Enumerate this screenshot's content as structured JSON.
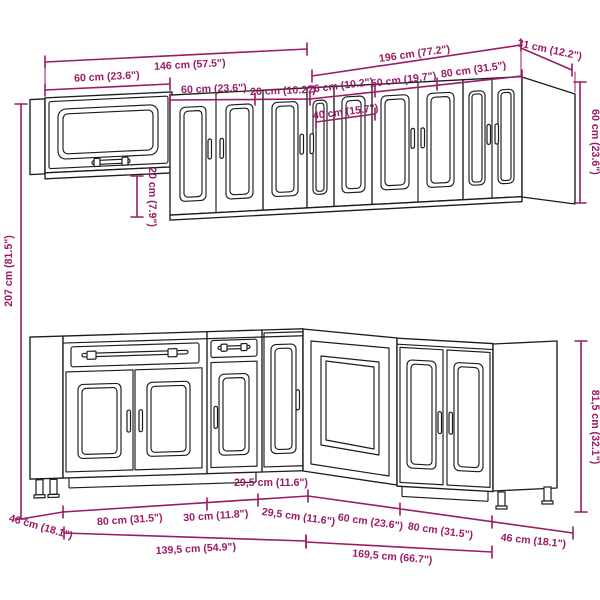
{
  "diagram": {
    "type": "kitchen-cabinet-set-dimension-diagram",
    "colors": {
      "dimension": "#9b1b66",
      "line": "#1c1c1c",
      "background": "#ffffff"
    },
    "dimensions": {
      "wall": {
        "total_left": "146 cm (57.5\")",
        "total_right": "196 cm (77.2\")",
        "return_depth": "31 cm (12.2\")",
        "glass_cabinet_width": "60 cm (23.6\")",
        "cabinet_60_width": "60 cm (23.6\")",
        "cabinet_26a_width": "26 cm (10.2\")",
        "cabinet_26b_width": "26 cm (10.2\")",
        "cabinet_50_width": "50 cm (19.7\")",
        "cabinet_80_width": "80 cm (31.5\")",
        "corner_cabinet_width": "40 cm (15.7\")",
        "cabinet_height": "60 cm (23.6\")",
        "gap_below_glass_cabinet": "20 cm (7.9\")",
        "total_height": "207 cm (81.5\")"
      },
      "base": {
        "cabinet_80_left_width": "80 cm (31.5\")",
        "cabinet_30_width": "30 cm (11.8\")",
        "corner_filler_left_width": "29,5 cm (11.6\")",
        "corner_filler_right_width": "29,5 cm (11.6\")",
        "corner_cabinet_width": "60 cm (23.6\")",
        "cabinet_80_right_width": "80 cm (31.5\")",
        "side_depth_right": "46 cm (18.1\")",
        "side_depth_left": "46 cm (18.1\")",
        "run_total_left": "139,5 cm (54.9\")",
        "run_total_right": "169,5 cm (66.7\")",
        "cabinet_height": "81,5 cm (32.1\")"
      }
    }
  }
}
